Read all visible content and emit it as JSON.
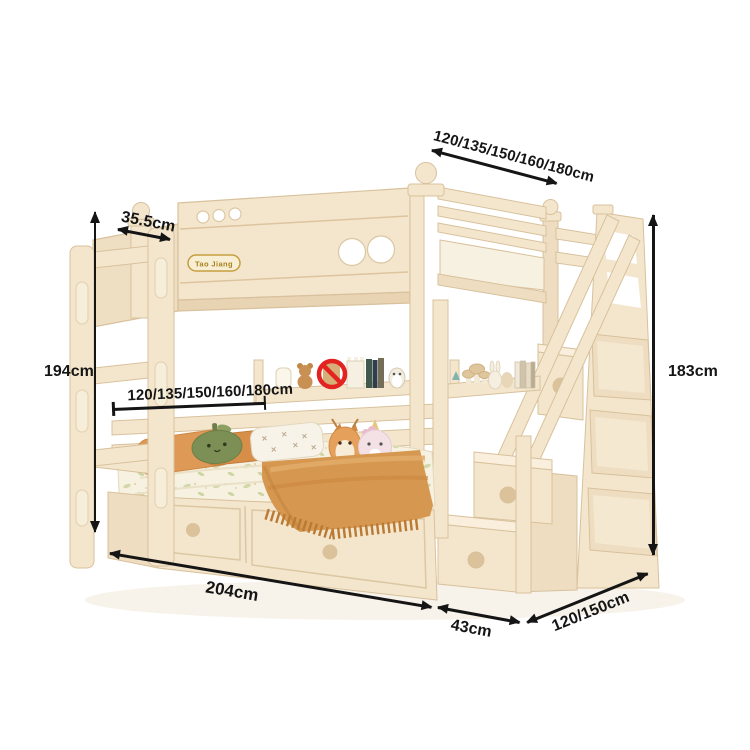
{
  "window": {
    "width": 750,
    "height": 750,
    "background": "#ffffff"
  },
  "product": {
    "badge": "Tao Jiang"
  },
  "annotations": {
    "top_width": {
      "label": "120/135/150/160/180cm"
    },
    "side_depth": {
      "label": "35.5cm"
    },
    "left_height": {
      "label": "194cm"
    },
    "inner_width": {
      "label": "120/135/150/160/180cm"
    },
    "right_height": {
      "label": "183cm"
    },
    "bottom_length": {
      "label": "204cm"
    },
    "stair_depth": {
      "label": "43cm"
    },
    "bed_depth": {
      "label": "120/150cm"
    }
  },
  "colors": {
    "frame_cream": "#f4e6cd",
    "frame_shadow": "#e6d0ad",
    "dimension_line": "#151515",
    "prohibition_red": "#e2231f",
    "blanket_orange": "#d69851",
    "pillow_orange": "#df9956",
    "pillow_green": "#7c8f55",
    "badge_gold": "#a8821e"
  },
  "icons": {
    "prohibition_icon": "red circle with diagonal slash"
  }
}
